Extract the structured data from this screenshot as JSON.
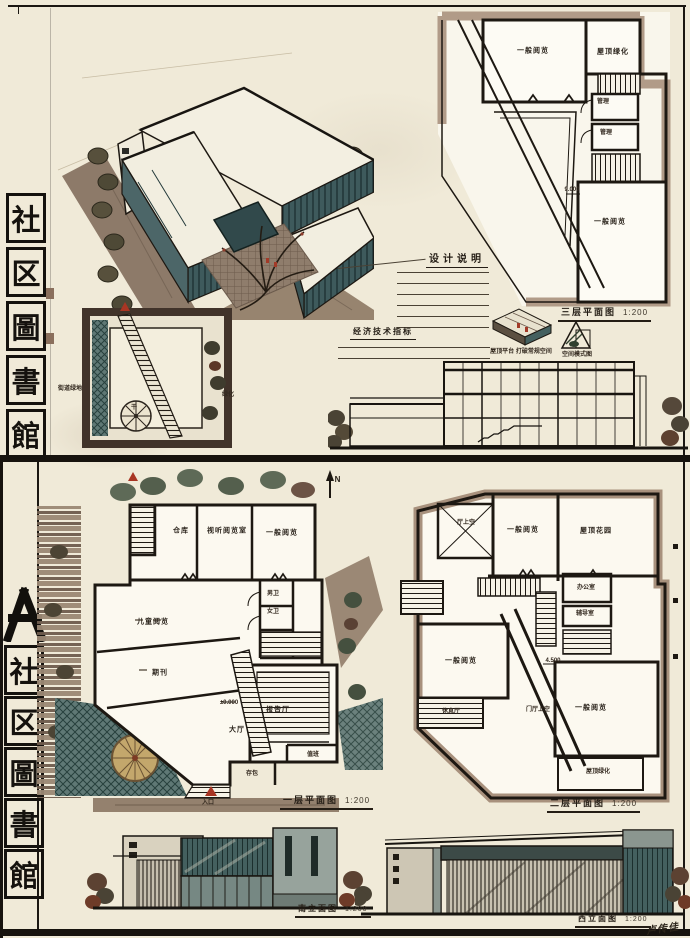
{
  "palette": {
    "paper": "#f0ead8",
    "ink": "#1d1812",
    "tan": "#a8917d",
    "teal": "#3e5a5c",
    "teal_dark": "#2c4244",
    "green": "#4e5c49",
    "red": "#a93523",
    "brown": "#8d7a69",
    "tree_tan": "#c3a76c"
  },
  "titles": {
    "top": {
      "chars": [
        "社",
        "区",
        "圖",
        "書",
        "館"
      ]
    },
    "bottom": {
      "chars": [
        "社",
        "区",
        "圖",
        "書",
        "館"
      ]
    }
  },
  "notes": {
    "design_title": "设计说明",
    "econ_title": "经济技术指标"
  },
  "sketches": {
    "roof_terrace_caption": "屋顶平台 打破常规空间",
    "massing_caption": "空间模式图"
  },
  "site_plan": {
    "labels": {
      "street_green": "街道绿地",
      "trunk": "干",
      "green": "绿化"
    }
  },
  "plans": {
    "third": {
      "title": "三层平面图",
      "scale": "1:200",
      "level_mark": "9.000",
      "rooms": [
        "一般阅览",
        "屋顶绿化",
        "管理",
        "管理",
        "一般阅览"
      ]
    },
    "first": {
      "title": "一层平面图",
      "scale": "1:200",
      "level_mark": "±0.000",
      "entry_label": "入口",
      "north": "N",
      "rooms": [
        "仓库",
        "视听阅览室",
        "一般阅览",
        "儿童阅览",
        "期刊",
        "男卫",
        "女卫",
        "大厅",
        "报告厅",
        "存包",
        "值班"
      ]
    },
    "second": {
      "title": "二层平面图",
      "scale": "1:200",
      "level_mark": "4.500",
      "rooms": [
        "厅上空",
        "一般阅览",
        "屋顶花园",
        "办公室",
        "辅导室",
        "一般阅览",
        "休息厅",
        "门厅上空",
        "一般阅览",
        "屋顶绿化"
      ]
    }
  },
  "elevations": {
    "south": {
      "title": "南立面图",
      "scale": "1:200"
    },
    "west": {
      "title": "西立面图",
      "scale": "1:200"
    }
  },
  "signature": "卢传佳"
}
